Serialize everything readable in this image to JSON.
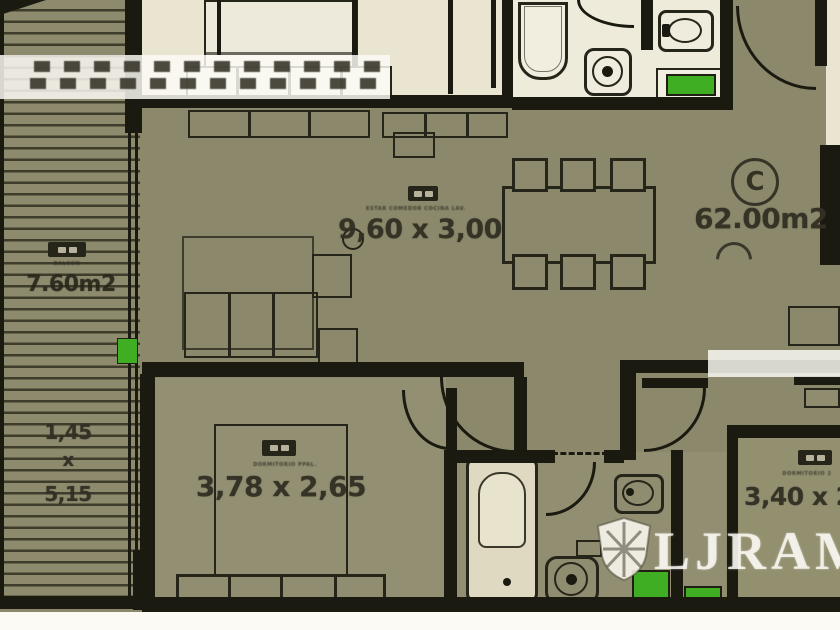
{
  "unit": {
    "circle_letter": "C",
    "area": "62.00m2"
  },
  "living": {
    "name": "ESTAR COMEDOR COCINA LAV.",
    "dims": "9,60 x 3,00"
  },
  "balcony": {
    "name": "BALCON",
    "area": "7.60m2",
    "width": "1,45",
    "times": "x",
    "depth": "5,15"
  },
  "bedroom1": {
    "name": "DORMITORIO PPAL.",
    "dims": "3,78 x 2,65"
  },
  "bedroom2": {
    "name": "DORMITORIO 2",
    "dims": "3,40 x 2"
  },
  "watermark": {
    "brand": "LJRAM"
  },
  "colors": {
    "floor": "#8b886b",
    "room_light": "#e9e5d1",
    "wall": "#1b1a10",
    "green": "#3fae22"
  }
}
